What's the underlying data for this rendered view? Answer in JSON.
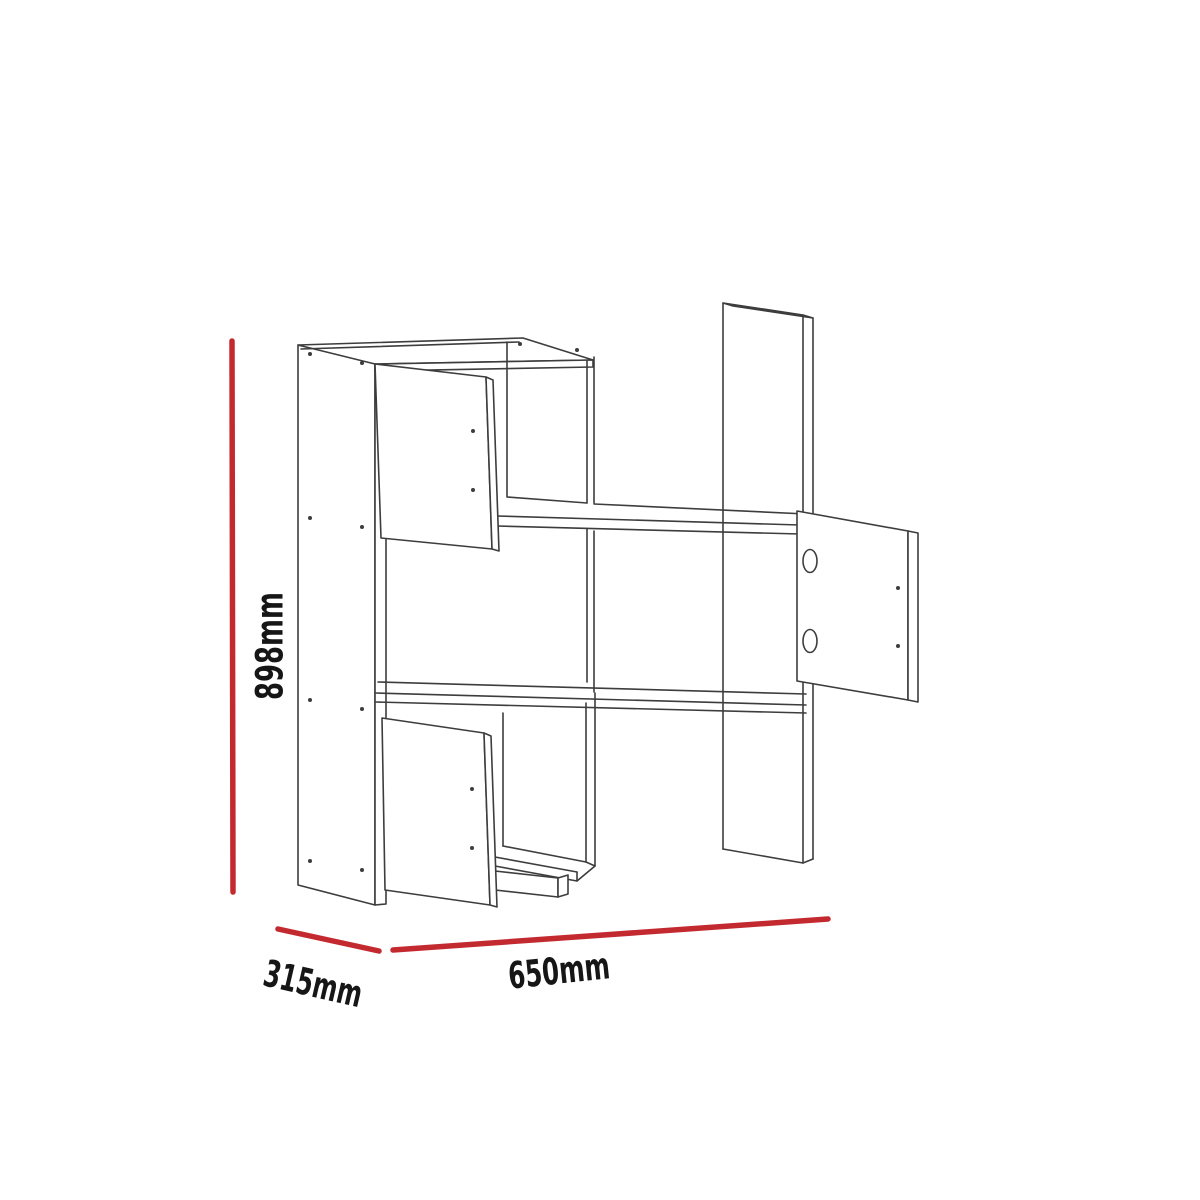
{
  "diagram": {
    "kind": "furniture-dimension-drawing",
    "subject": "wall-mounted shelf unit, isometric line drawing with three open doors",
    "dimension_labels": {
      "height": "898mm",
      "depth": "315mm",
      "width": "650mm"
    },
    "colors": {
      "background": "#ffffff",
      "drawing_line": "#3d3d3d",
      "dimension_line": "#c32a30",
      "label_text": "#161616"
    }
  }
}
